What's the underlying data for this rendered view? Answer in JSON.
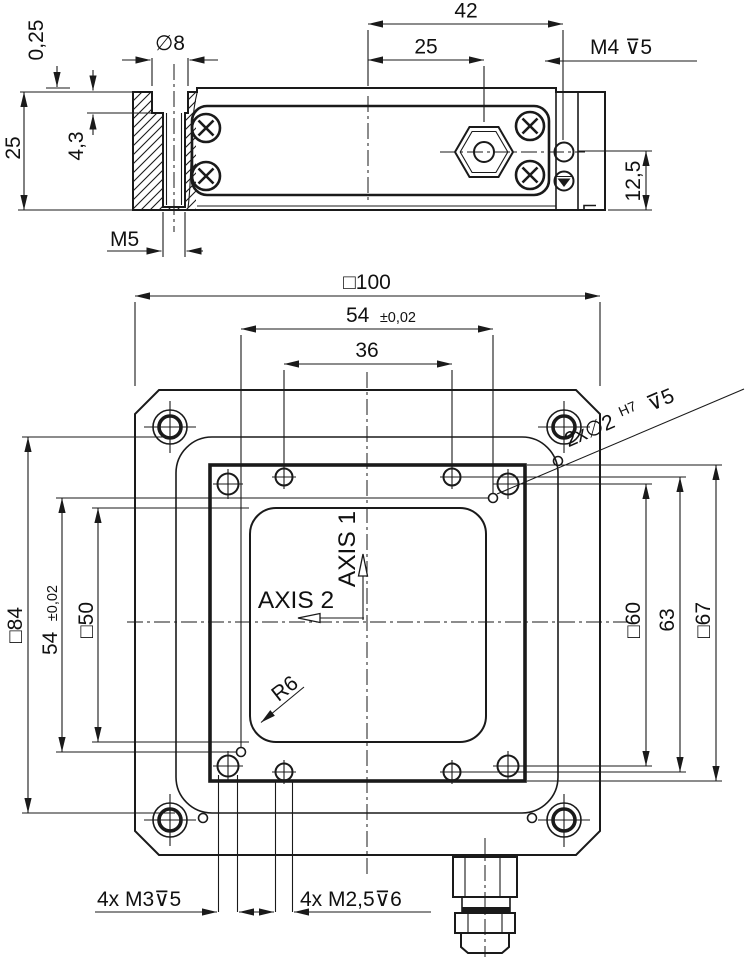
{
  "side_view": {
    "dim_0_25": "0,25",
    "dim_dia8": "∅8",
    "dim_42": "42",
    "dim_25_top": "25",
    "dim_m4": "M4 ⊽5",
    "dim_25_left": "25",
    "dim_4_3": "4,3",
    "dim_m5": "M5",
    "dim_12_5": "12,5"
  },
  "top_view": {
    "dim_sq100": "□100",
    "dim_54_top": {
      "value": "54",
      "tol": "±0,02"
    },
    "dim_36": "36",
    "dim_dowel": {
      "prefix": "2x∅2",
      "fit": "H7",
      "suffix": "⊽5"
    },
    "dim_sq84": "□84",
    "dim_54_left": {
      "value": "54",
      "tol": "±0,02"
    },
    "dim_sq50": "□50",
    "dim_sq60": "□60",
    "dim_63": "63",
    "dim_sq67": "□67",
    "axis1": "AXIS 1",
    "axis2": "AXIS 2",
    "dim_r6": "R6",
    "dim_m3": "4x M3⊽5",
    "dim_m25": "4x M2,5⊽6"
  }
}
